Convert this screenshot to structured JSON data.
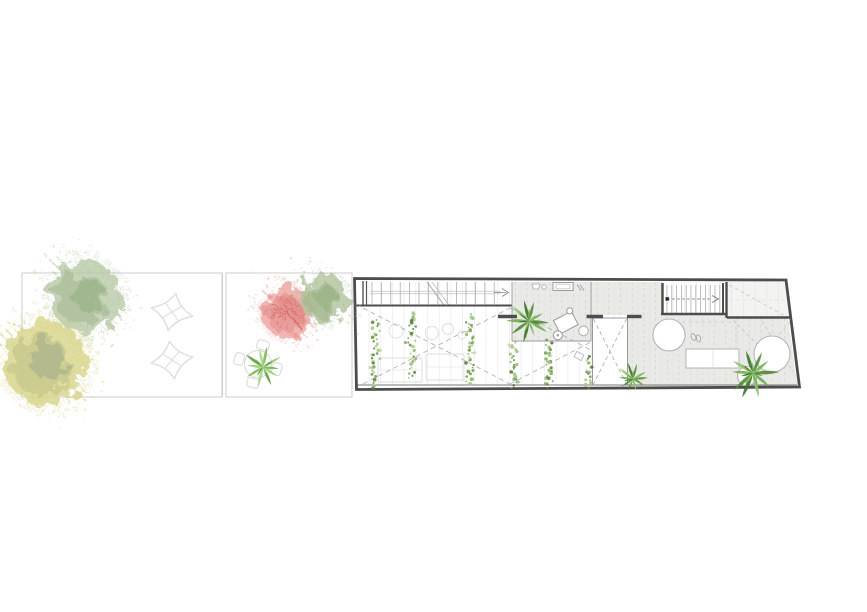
{
  "meta": {
    "description": "Architectural plan drawing: long narrow house upper-floor plan (right) with stairs, voids, gray deck, palms and hanging vines, plus a walled garden (left) with watercolor trees, star pavers and a round dining set. No text labels are present in the drawing."
  },
  "palette": {
    "wall": "#4d4d4d",
    "wall_mid": "#777777",
    "floor_gray": "#e9e9e6",
    "room_light": "#f3f3f1",
    "grid": "#e4e4e4",
    "grid_dash": "#c9c9c9",
    "dash_line": "#b3b3b3",
    "dash_light": "#c6c6c6",
    "ghost": "#dcdcdc",
    "garden_border": "#d2d2d2",
    "star_outline": "#dedede",
    "furniture_outline": "#b5b5b5",
    "tread": "#a8a8a8",
    "stair_arrow": "#808080",
    "vine_greens": [
      "#6f9e4a",
      "#8ab562",
      "#557f38",
      "#a3c687"
    ],
    "palm_greens_dark": [
      "#4f8a33",
      "#6fae4e",
      "#8cc468",
      "#3c7427"
    ],
    "palm_greens_light": [
      "#7ab84f",
      "#96cc71",
      "#5d9c3c",
      "#a9d489"
    ]
  },
  "garden": {
    "sections": [
      {
        "x": 22,
        "y": 273,
        "w": 200,
        "h": 124
      },
      {
        "x": 226,
        "y": 273,
        "w": 126,
        "h": 124
      }
    ],
    "divider_x": [
      222.5,
      226
    ],
    "trees": [
      {
        "id": "sage-tree-large",
        "cx": 85,
        "cy": 296,
        "r": 36,
        "base": "#b6c8a5",
        "inner": "#a0b78c",
        "core": "#8fa87c"
      },
      {
        "id": "yellow-tree",
        "cx": 45,
        "cy": 362,
        "r": 42,
        "base": "#d6d385",
        "inner": "#bcc083",
        "core": "#99a48b"
      },
      {
        "id": "pink-tree",
        "cx": 288,
        "cy": 312,
        "r": 26,
        "base": "#eda3a0",
        "inner": "#e58a86",
        "core": "#de807c",
        "branches": "#c0524d"
      },
      {
        "id": "sage-tree-small",
        "cx": 324,
        "cy": 298,
        "r": 24,
        "base": "#afc29b",
        "inner": "#9cb285",
        "core": "#8da97a"
      }
    ],
    "stars": [
      {
        "cx": 172,
        "cy": 312,
        "rot": 12
      },
      {
        "cx": 172,
        "cy": 360,
        "rot": -8
      }
    ],
    "dining": {
      "cx": 258,
      "cy": 364,
      "table_r": 13.5,
      "chair_angles": [
        -75,
        15,
        105,
        195
      ],
      "chair_dist": 19.5
    },
    "garden_plant": {
      "cx": 263,
      "cy": 367,
      "r": 21
    }
  },
  "building": {
    "grid": {
      "x0": 369,
      "x1": 782,
      "step": 11.7,
      "y0": 282,
      "y1": 385
    },
    "corridor_treads": {
      "x0": 372,
      "count": 14,
      "step": 9.4,
      "y0": 282,
      "y1": 304
    },
    "stair_treads": {
      "x0": 667,
      "count": 12,
      "step": 4.8,
      "y0": 285,
      "y1": 313
    },
    "vines": [
      {
        "x": 376,
        "y1": 320,
        "y2": 390
      },
      {
        "x": 412,
        "y1": 312,
        "y2": 380
      },
      {
        "x": 470,
        "y1": 315,
        "y2": 385
      },
      {
        "x": 514,
        "y1": 343,
        "y2": 390
      },
      {
        "x": 549,
        "y1": 341,
        "y2": 390
      },
      {
        "x": 589,
        "y1": 357,
        "y2": 390
      }
    ],
    "palms": [
      {
        "id": "palm-landing",
        "cx": 529,
        "cy": 321,
        "r": 22,
        "tone": "dark"
      },
      {
        "id": "palm-deck-center",
        "cx": 633,
        "cy": 379,
        "r": 17,
        "tone": "dark"
      },
      {
        "id": "palm-deck-right",
        "cx": 753,
        "cy": 373,
        "r": 26,
        "tone": "dark"
      }
    ],
    "openings": [
      {
        "id": "deck-opening-left",
        "cx": 669,
        "cy": 335,
        "r": 16
      },
      {
        "id": "deck-opening-right",
        "cx": 772,
        "cy": 354,
        "r": 18
      },
      {
        "id": "deck-opening-small",
        "cx": 747,
        "cy": 376,
        "r": 9.5
      },
      {
        "id": "stool",
        "cx": 583.5,
        "cy": 331,
        "r": 4.8
      }
    ],
    "ghost_circles": [
      {
        "cx": 396,
        "cy": 331,
        "r": 7
      },
      {
        "cx": 432,
        "cy": 333,
        "r": 6.5
      },
      {
        "cx": 448,
        "cy": 329,
        "r": 5.5
      },
      {
        "cx": 462,
        "cy": 335,
        "r": 4
      }
    ],
    "ghost_rects": [
      {
        "x": 378,
        "y": 358,
        "w": 44,
        "h": 24
      },
      {
        "x": 426,
        "y": 354,
        "w": 38,
        "h": 26
      }
    ]
  }
}
